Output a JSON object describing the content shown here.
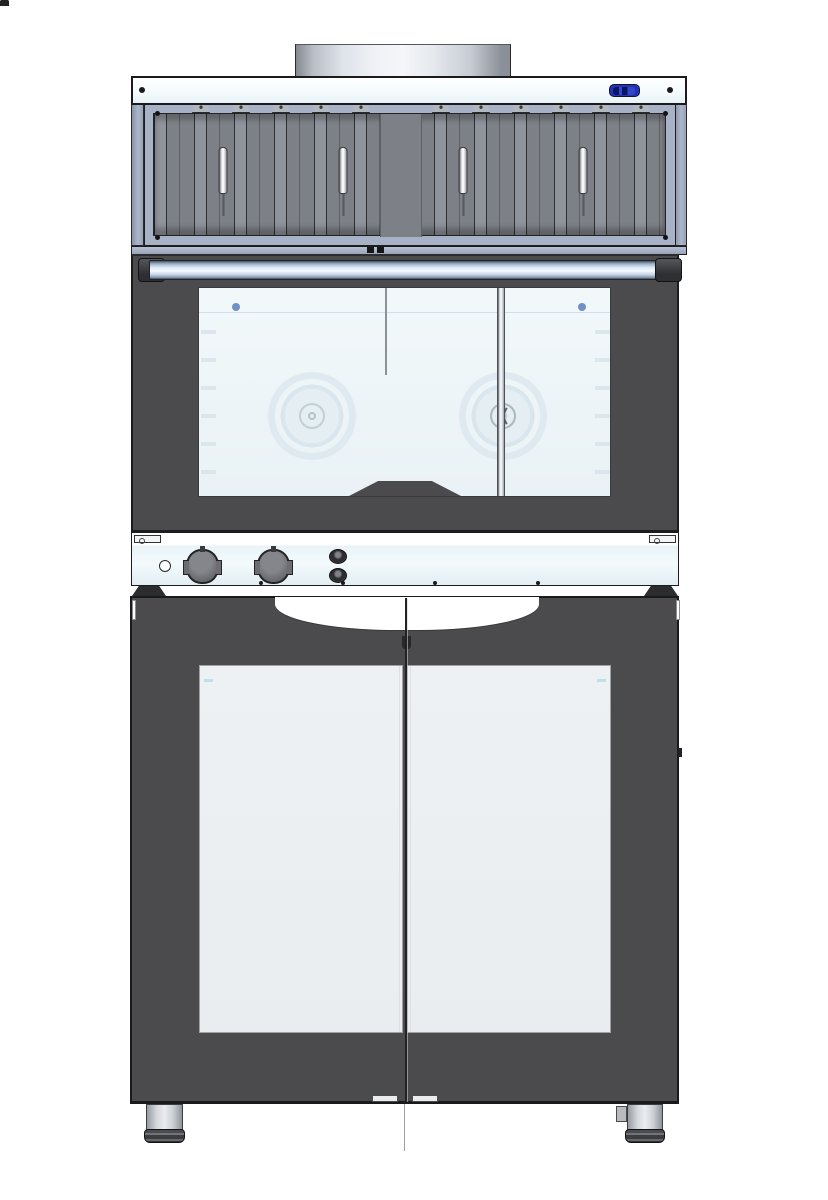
{
  "meta": {
    "type": "cad-product-render",
    "subject": "Front view of a commercial bakery oven stack: condensation hood with grease filters and exhaust pipe, convection oven with glass door and knob control panel, proofer cabinet base with double glass doors and cylindrical feet",
    "background_color": "#ffffff",
    "visible_text": ""
  },
  "palette": {
    "body_dark_gray": "#4b4b4d",
    "frame_steel_blue": "#a8b2c7",
    "filter_panel_gray": "#7d8086",
    "filter_groove_gray": "#8f939b",
    "panel_white": "#f3fafc",
    "oven_glass": "#eef5f8",
    "cabinet_glass": "#eef1f3",
    "metal_chrome_light": "#f5fafe",
    "display_blue": "#2233b8",
    "glass_accent_dot_blue": "#7191c4",
    "outline_dark": "#1c1c1e",
    "foot_gray": "#d5d8dc"
  },
  "hood": {
    "pipe_nubs": [
      {
        "x": 318,
        "y": 70
      },
      {
        "x": 482,
        "y": 70
      }
    ],
    "band_screws": [
      {
        "x": 6,
        "y": 9
      },
      {
        "x": 534,
        "y": 9
      }
    ],
    "display_badge_color": "#2233b8",
    "frame_screws": [
      {
        "x": 10,
        "y": 6
      },
      {
        "x": 518,
        "y": 6
      },
      {
        "x": 10,
        "y": 130
      },
      {
        "x": 518,
        "y": 130
      }
    ],
    "filter_handles": [
      {
        "x": 69
      },
      {
        "x": 189
      },
      {
        "x": 309
      },
      {
        "x": 429
      }
    ],
    "filter_brackets": [
      {
        "x": 47
      },
      {
        "x": 87
      },
      {
        "x": 127
      },
      {
        "x": 167
      },
      {
        "x": 207
      },
      {
        "x": 287
      },
      {
        "x": 327
      },
      {
        "x": 367
      },
      {
        "x": 407
      },
      {
        "x": 447
      },
      {
        "x": 487
      }
    ],
    "rail_marks": [
      {
        "x": 367,
        "y": 247
      },
      {
        "x": 377,
        "y": 247
      }
    ]
  },
  "oven": {
    "window_dots": [
      {
        "x": 33,
        "y": 15
      },
      {
        "x": 379,
        "y": 15
      }
    ],
    "fan_count": 2,
    "knob_count": 2,
    "button_count": 2,
    "panel_screws": [
      {
        "x": 127,
        "y": 48
      },
      {
        "x": 209,
        "y": 48
      },
      {
        "x": 301,
        "y": 48
      },
      {
        "x": 404,
        "y": 48
      }
    ]
  },
  "cabinet": {
    "door_count": 2,
    "door_latches": [
      {
        "x": 240
      },
      {
        "x": 280
      }
    ],
    "foot_count": 2
  }
}
